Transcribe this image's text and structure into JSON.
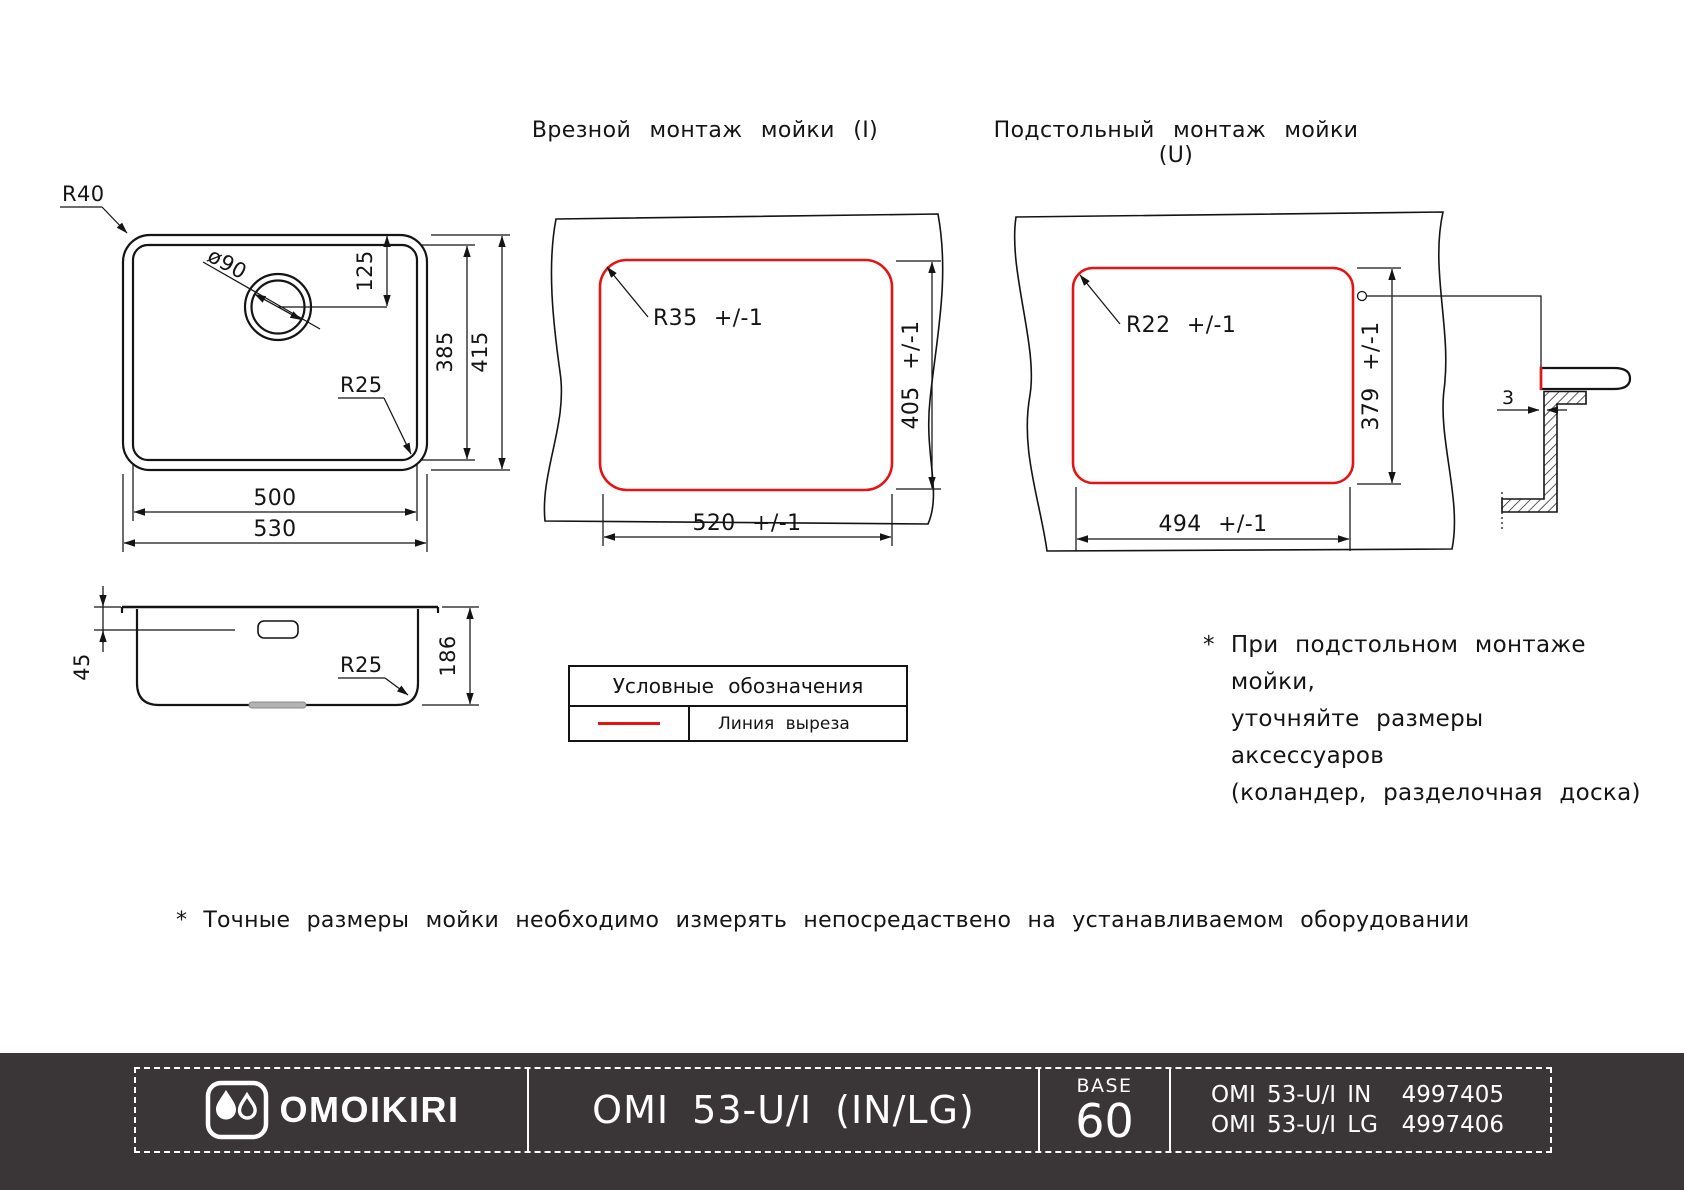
{
  "colors": {
    "line": "#141414",
    "cut_line": "#e51414",
    "footer_bg": "#3a3637",
    "footer_fg": "#ffffff"
  },
  "top_view": {
    "corner_outer": "R40",
    "drain_dia": "ø90",
    "drain_offset": "125",
    "inner_height": "385",
    "outer_height": "415",
    "corner_inner": "R25",
    "inner_width": "500",
    "outer_width": "530"
  },
  "inset_view": {
    "title": "Врезной монтаж мойки (I)",
    "radius": "R35 +/-1",
    "height": "405 +/-1",
    "width": "520 +/-1"
  },
  "under_view": {
    "title": "Подстольный монтаж мойки (U)",
    "radius": "R22 +/-1",
    "height": "379 +/-1",
    "width": "494 +/-1",
    "gap": "3"
  },
  "side_view": {
    "overflow_offset": "45",
    "height": "186",
    "corner": "R25"
  },
  "legend": {
    "title": "Условные обозначения",
    "cut_line_label": "Линия выреза"
  },
  "notes": {
    "asterisk": "*",
    "mount": [
      "При подстольном монтаже мойки,",
      "уточняйте размеры аксессуаров",
      "(коландер, разделочная доска)"
    ],
    "measure": "Точные размеры мойки необходимо измерять непосредаствено на устанавливаемом оборудовании"
  },
  "footer": {
    "brand": "OMOIKIRI",
    "model": "OMI 53-U/I (IN/LG)",
    "base_label": "BASE",
    "base_value": "60",
    "skus": [
      {
        "name": "OMI 53-U/I IN",
        "code": "4997405"
      },
      {
        "name": "OMI 53-U/I LG",
        "code": "4997406"
      }
    ]
  }
}
